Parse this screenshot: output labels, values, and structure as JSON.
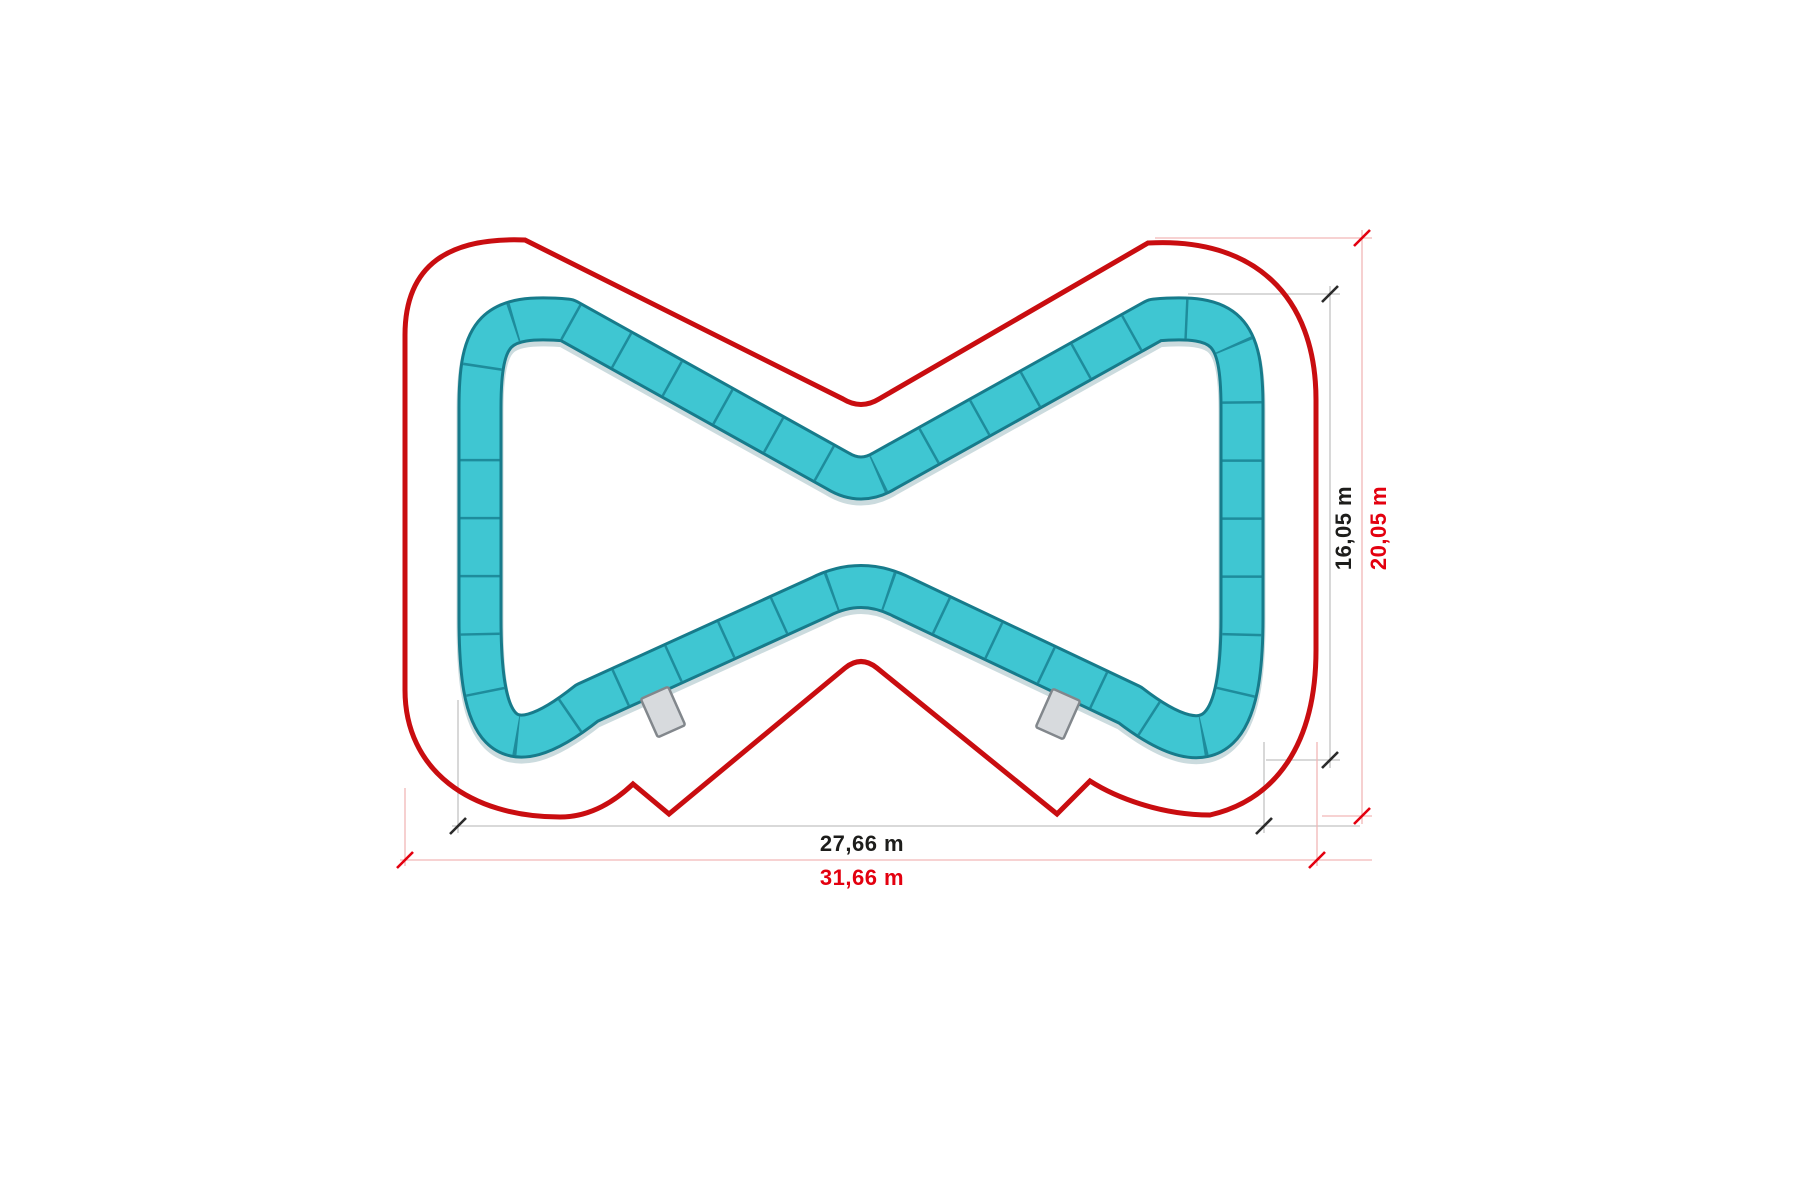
{
  "diagram": {
    "title": "pumptrack-layout-plan",
    "units": "m",
    "dimensions": {
      "track_width_label": "27,66 m",
      "boundary_width_label": "31,66 m",
      "track_height_label": "16,05 m",
      "boundary_height_label": "20,05 m"
    },
    "mats": {
      "count": 2
    },
    "colors": {
      "background": "#ffffff",
      "track_fill": "#3fc6d2",
      "track_edge": "#177b8b",
      "track_seam": "#1e8c9c",
      "track_shadow": "rgba(20,90,104,0.22)",
      "boundary_red": "#c90d10",
      "dim_text_black": "#1d1d1b",
      "dim_text_red": "#e3000f",
      "tick_black": "#2b2b2b",
      "tick_red": "#e3000f",
      "thin_line_gray": "#c2c2c2",
      "thin_line_red": "#f2b6b6",
      "mat_fill": "#d7dadd",
      "mat_edge": "#82878c"
    }
  }
}
